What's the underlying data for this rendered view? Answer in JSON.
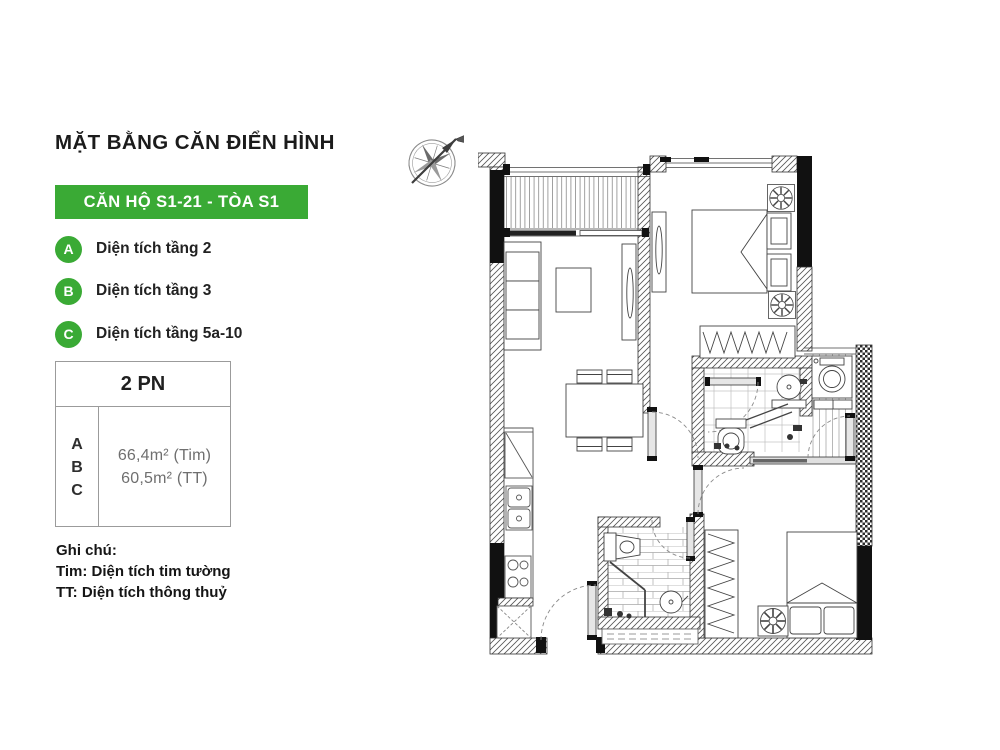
{
  "theme": {
    "accent": "#3aaa35",
    "line_color": "#3a3a3a",
    "background": "#ffffff"
  },
  "header": {
    "title": "MẶT BẰNG CĂN ĐIỂN HÌNH"
  },
  "banner": {
    "label": "CĂN HỘ S1-21 - TÒA S1"
  },
  "legend": {
    "items": [
      {
        "key": "A",
        "label": "Diện tích tầng 2"
      },
      {
        "key": "B",
        "label": "Diện tích tầng 3"
      },
      {
        "key": "C",
        "label": "Diện tích tầng 5a-10"
      }
    ]
  },
  "unit_table": {
    "header": "2 PN",
    "row_keys": [
      "A",
      "B",
      "C"
    ],
    "areas": [
      "66,4m² (Tim)",
      "60,5m² (TT)"
    ]
  },
  "notes": {
    "heading": "Ghi chú:",
    "lines": [
      "Tim: Diện tích tim tường",
      "TT: Diện tích thông thuỷ"
    ]
  }
}
